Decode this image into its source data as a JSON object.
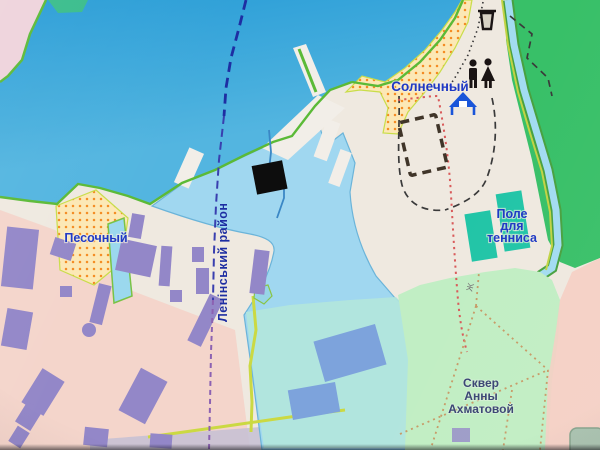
{
  "labels": {
    "settlement_top": "Солнечный",
    "settlement_left": "Песочный",
    "district_boundary": "Ленінський район",
    "tennis_field": [
      "Поле",
      "для",
      "тенниса"
    ],
    "akhmatova_square": [
      "Сквер",
      "Анны",
      "Ахматовой"
    ],
    "small_char": "Ж"
  },
  "icons": {
    "waste_bin_icon": "🗑",
    "wc_icon": "🚻",
    "beach_shelter_icon": "⛺"
  },
  "colors": {
    "sea": "#2E9BD1",
    "sea_light": "#58B4DC",
    "harbor": "#A3D6EE",
    "harbor_south": "#B6E5DB",
    "forest": "#3FBE6B",
    "park": "#C3EDC6",
    "land": "#EFE9E1",
    "land_pink": "#F3CEC4",
    "corner_pink": "#EDD3DB",
    "beach": "#FBE8B8",
    "beach_dot": "#EE8D2A",
    "building_purple": "#9387C4",
    "building_blue": "#7FA3D8",
    "court_teal": "#2AC3A7",
    "stream": "#A5DBEF",
    "stream_edge": "#4C9F45",
    "shore_green": "#5FB83E",
    "road_yellow": "#CBD84B",
    "road_gray": "#C6C0D2",
    "pier_white": "#F2EEE8",
    "label_blue": "#2038BC",
    "label_navy": "#3A4470",
    "boundary_navy": "#1F2E9B",
    "boundary_mid": "#3A3FA8",
    "boundary_purple": "#8A63AE",
    "path_red": "#D25C5C",
    "path_tan": "#C49A6A",
    "footpath": "#3A3A3A",
    "construction": "#3F352A",
    "marker": "#0D0D0D",
    "icon_black": "#1A1414",
    "icon_blue": "#1D55D0"
  }
}
